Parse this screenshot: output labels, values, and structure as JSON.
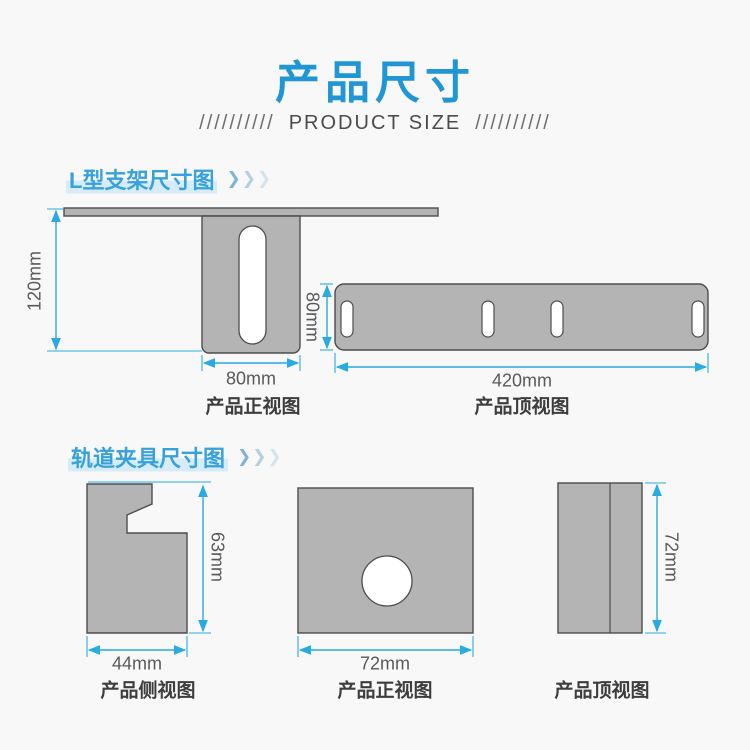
{
  "title": {
    "text": "产品尺寸"
  },
  "subtitle": {
    "slashes_left": "//////////",
    "text": "PRODUCT SIZE",
    "slashes_right": "//////////"
  },
  "icons": {
    "chevron": "❯"
  },
  "colors": {
    "accent_blue": "#2196d4",
    "heading_blue": "#36a1db",
    "dimension_blue": "#29abe2",
    "shape_gray": "#b4b4b4",
    "outline_dark": "#4d4d4f",
    "background": "#f8f8f8"
  },
  "sections": [
    {
      "heading": "L型支架尺寸图",
      "figures": [
        {
          "caption": "产品正视图",
          "height_label": "120mm",
          "width_label": "80mm"
        },
        {
          "caption": "产品顶视图",
          "height_label": "80mm",
          "width_label": "420mm"
        }
      ]
    },
    {
      "heading": "轨道夹具尺寸图",
      "figures": [
        {
          "caption": "产品侧视图",
          "height_label": "63mm",
          "width_label": "44mm"
        },
        {
          "caption": "产品正视图",
          "width_label": "72mm"
        },
        {
          "caption": "产品顶视图",
          "height_label": "72mm"
        }
      ]
    }
  ]
}
